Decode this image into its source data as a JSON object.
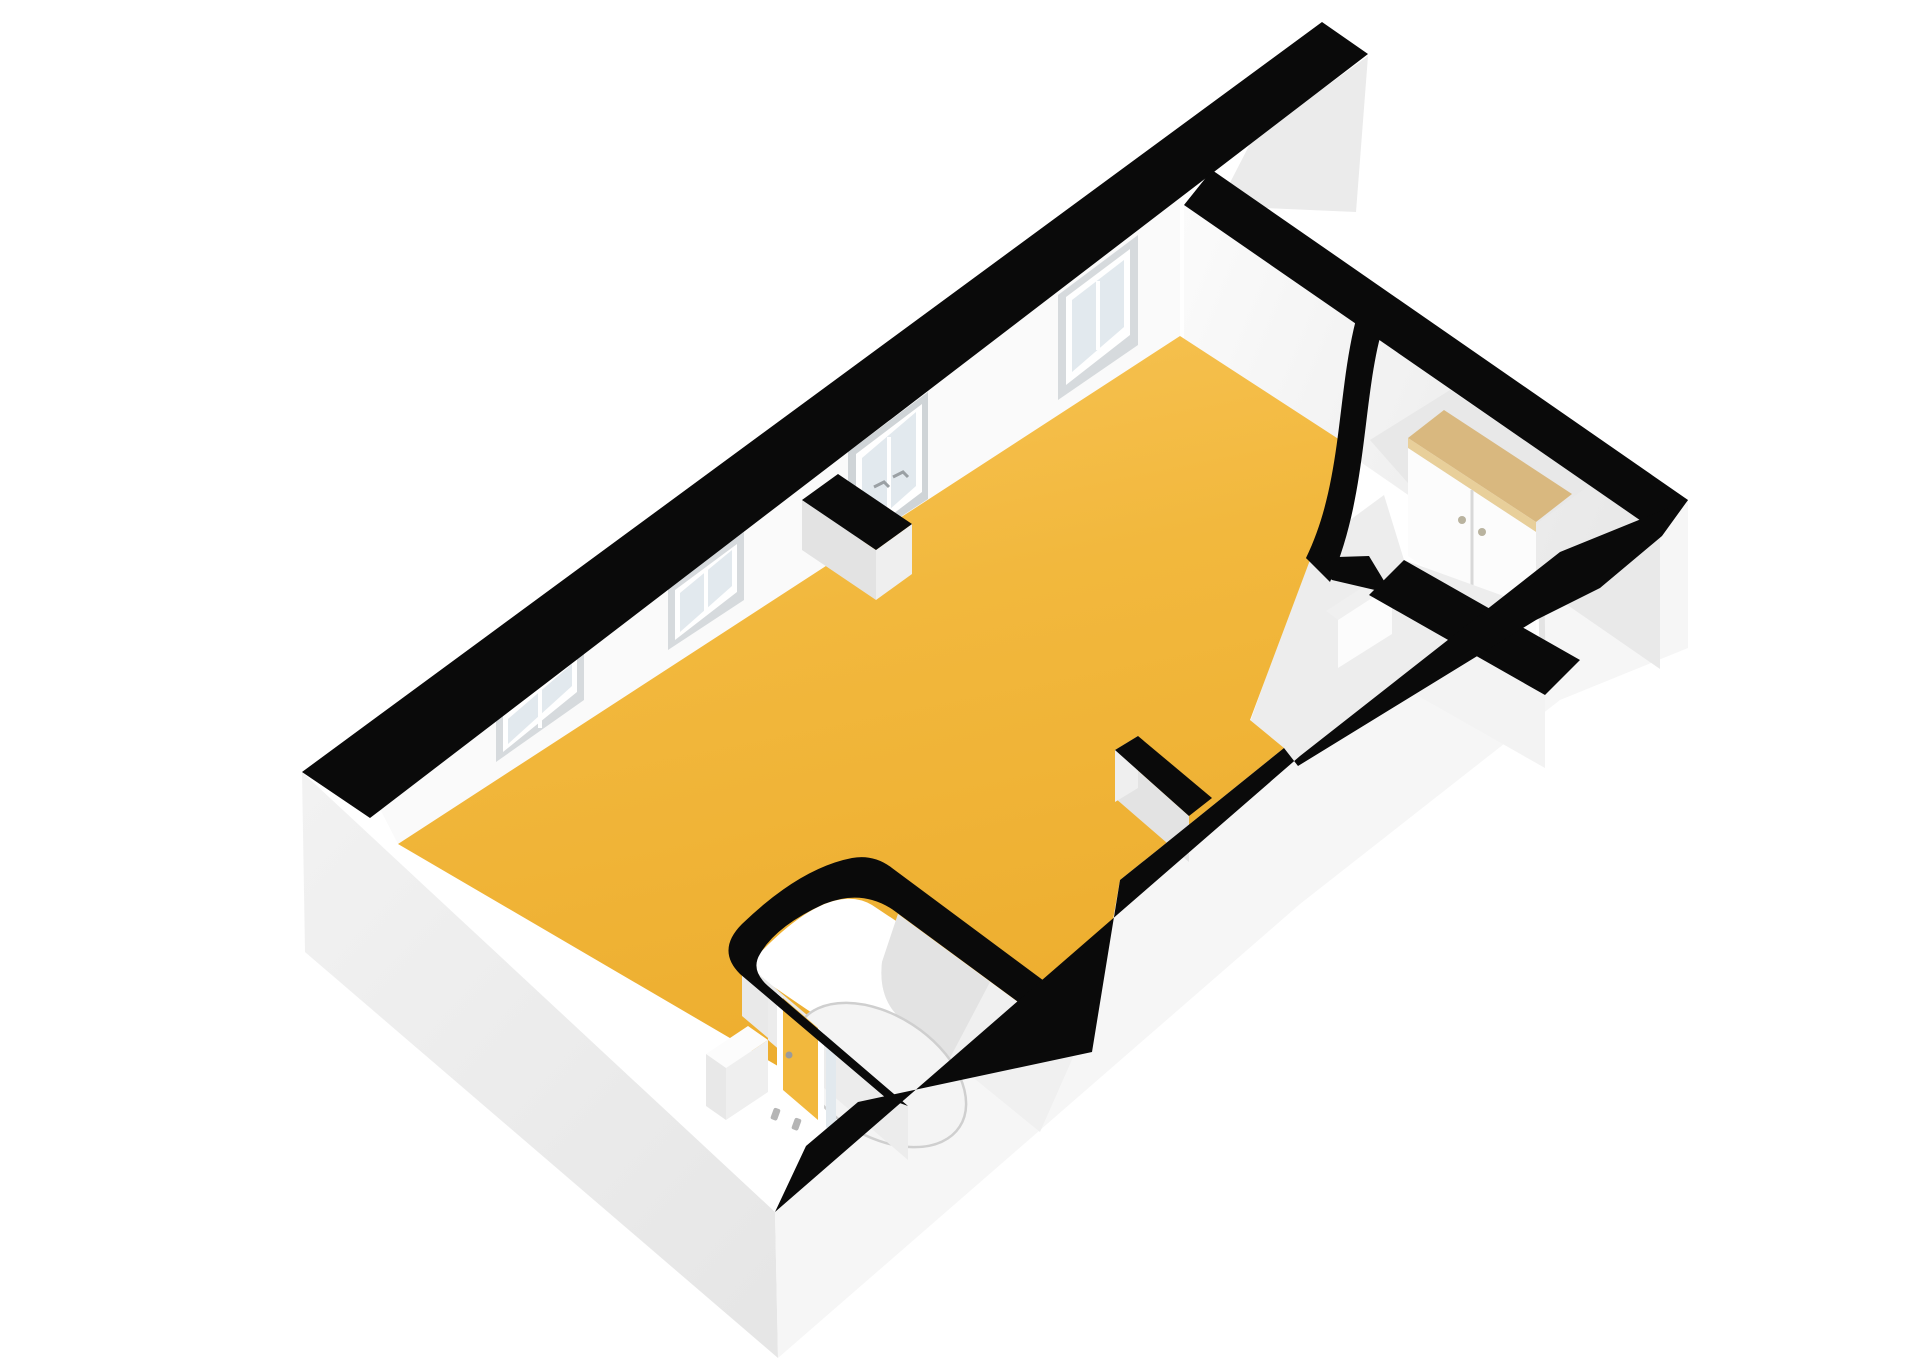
{
  "scene": {
    "type": "3d-floorplan-render",
    "view": "axonometric-top-down",
    "background": "#ffffff"
  },
  "colors": {
    "floor_main": "#F2B83D",
    "floor_main_light": "#F7C558",
    "floor_main_deep": "#EDAE2F",
    "wall_top_black": "#0a0a0a",
    "wall_interior": "#fafafa",
    "wall_interior_shaded": "#ececec",
    "exterior_sw_face": "#ededed",
    "exterior_se_face": "#f6f6f6",
    "exterior_protrude_face": "#ebebeb",
    "pocket_floor": "#f0f0f0",
    "pocket_floor_shadow": "#e3e3e3",
    "reveal": "#d6dadd",
    "frame_white": "#ffffff",
    "glass": "#e2e9ee",
    "wood_top": "#d9b87f",
    "wood_top_edge": "#e8cf9a",
    "fixture_white": "#fcfcfc",
    "fixture_side": "#e8e8e8",
    "handle_gray": "#9aa0a4"
  },
  "rooms": [
    {
      "id": "main-room",
      "floor": "yellow"
    },
    {
      "id": "bathroom",
      "floor": "white",
      "shape": "rounded-corner-pocket"
    },
    {
      "id": "entry-hall",
      "floor": "white"
    },
    {
      "id": "closet-niche",
      "floor": "white"
    }
  ],
  "doors": [
    {
      "id": "entry-door",
      "wall": "southeast-exterior",
      "type": "panel"
    },
    {
      "id": "glazed-door",
      "wall": "northwest",
      "type": "double-glazed"
    },
    {
      "id": "bathroom-door",
      "type": "open-leaf",
      "color": "yellow"
    }
  ],
  "windows": [
    {
      "id": "window-1",
      "wall": "northwest"
    },
    {
      "id": "window-2",
      "wall": "northwest"
    },
    {
      "id": "window-3",
      "wall": "northwest"
    }
  ],
  "fixtures": [
    {
      "id": "wardrobe",
      "location": "closet-niche",
      "top": "wood"
    },
    {
      "id": "shower",
      "location": "bathroom",
      "base": "round"
    },
    {
      "id": "vanity",
      "location": "bathroom"
    },
    {
      "id": "entry-cabinet",
      "location": "entry-hall"
    }
  ]
}
